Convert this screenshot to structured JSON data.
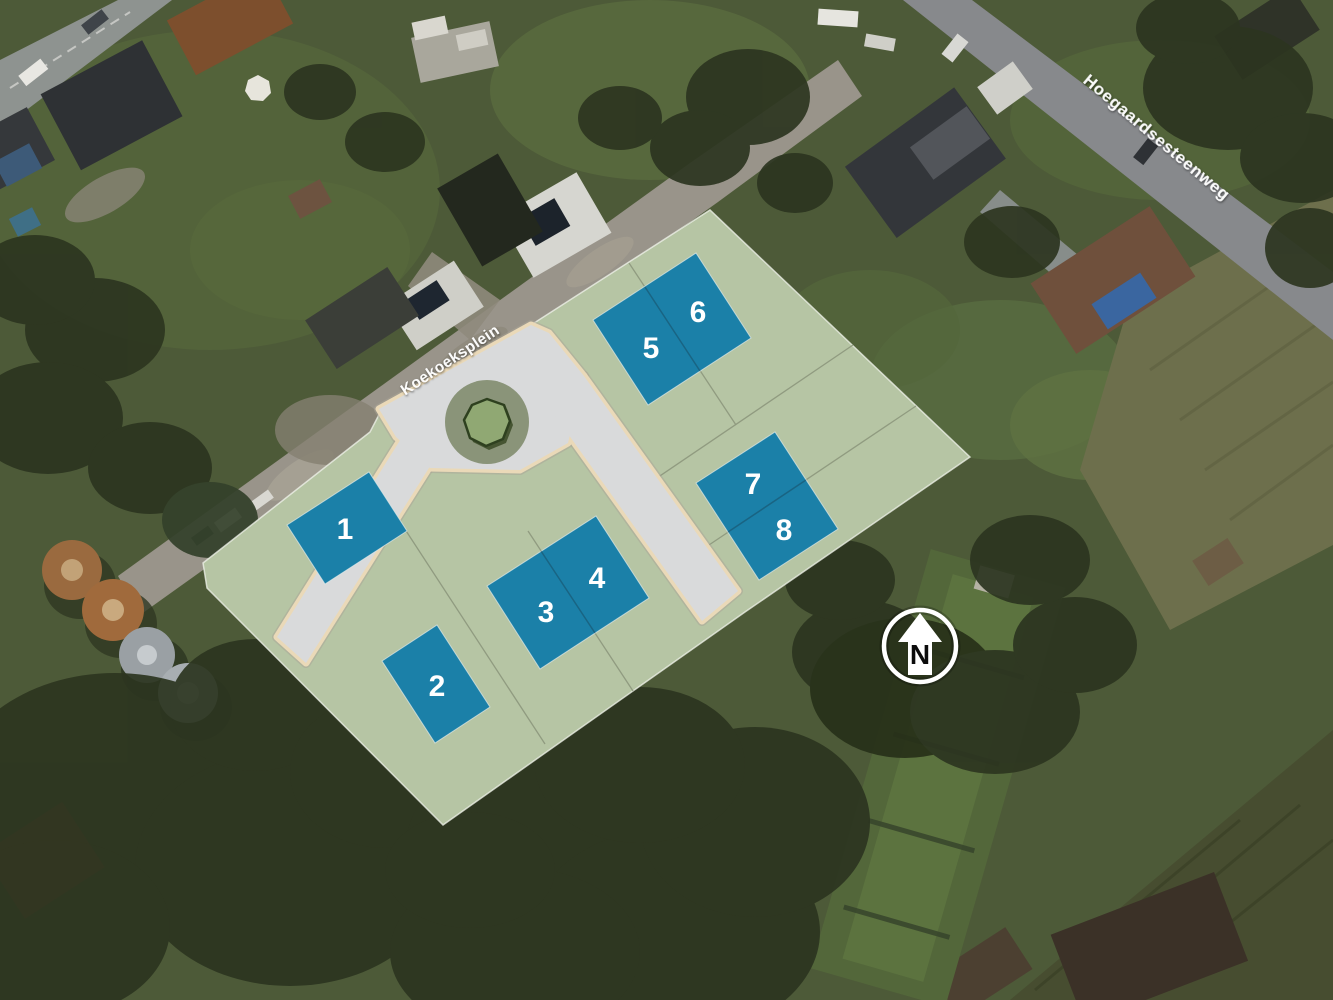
{
  "plan": {
    "streets": [
      {
        "label": "Koekoeksplein"
      },
      {
        "label": "Hoegaardsesteenweg"
      }
    ],
    "lots": [
      {
        "label": "1"
      },
      {
        "label": "2"
      },
      {
        "label": "3"
      },
      {
        "label": "4"
      },
      {
        "label": "5"
      },
      {
        "label": "6"
      },
      {
        "label": "7"
      },
      {
        "label": "8"
      }
    ],
    "north": {
      "label": "N"
    },
    "colors": {
      "lot_fill": "#1b80a8",
      "overlay_green": "#b6c5a4",
      "road_fill": "#d9dadb",
      "road_edge": "#ead9b8"
    }
  }
}
